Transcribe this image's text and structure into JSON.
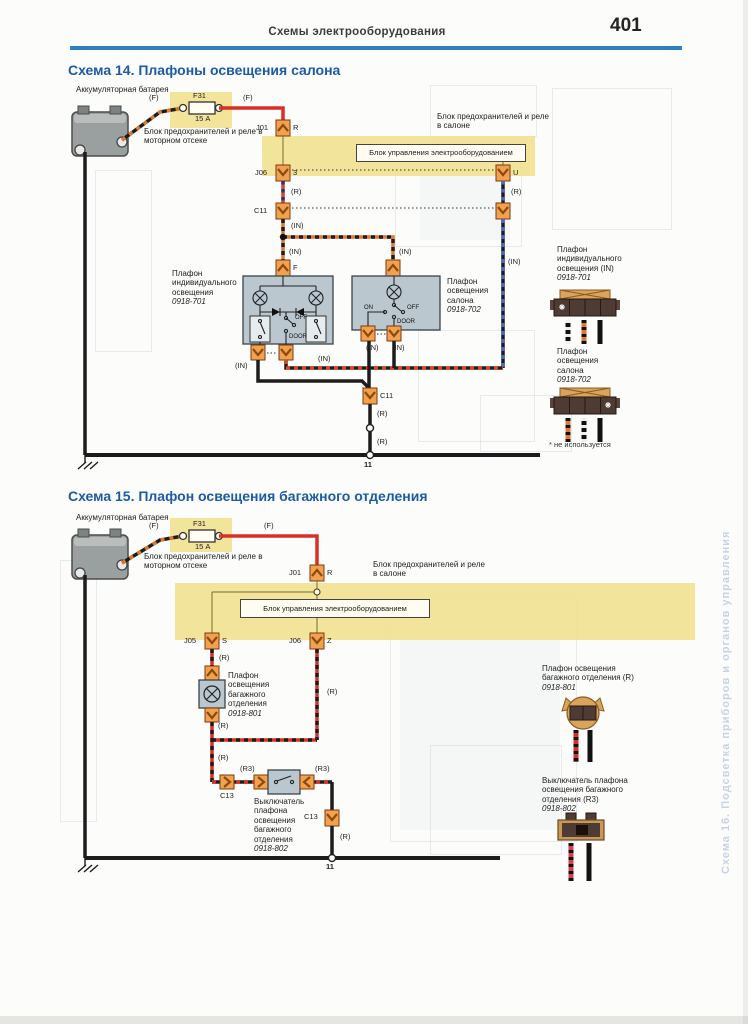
{
  "page": {
    "header": "Схемы электрооборудования",
    "number": "401"
  },
  "common": {
    "battery": "Аккумуляторная батарея",
    "wire_f": "(F)",
    "fuse": "F31",
    "fuse_rating": "15 А",
    "engine_block": "Блок предохранителей и реле в моторном отсеке",
    "cabin_block": "Блок предохранителей и реле в салоне",
    "ecu": "Блок управления электрооборудованием",
    "j01": "J01",
    "pin_r": "R",
    "wire_r": "(R)",
    "wire_in": "(IN)",
    "ground_node": "11"
  },
  "s14": {
    "title": "Схема 14. Плафоны освещения салона",
    "j06": "J06",
    "pin_3": "3",
    "pin_u": "U",
    "c11": "C11",
    "pin_f": "F",
    "sw_on": "ON",
    "sw_off": "OFF",
    "sw_door": "DOOR",
    "lamp1": {
      "name": "Плафон индивидуального освещения",
      "code": "0918-701"
    },
    "lamp2": {
      "name": "Плафон освещения салона",
      "code": "0918-702"
    },
    "legend": [
      {
        "name": "Плафон индивидуального освещения (IN)",
        "code": "0918-701"
      },
      {
        "name": "Плафон освещения салона",
        "code": "0918-702"
      }
    ],
    "footnote": "* не используется"
  },
  "s15": {
    "title": "Схема 15. Плафон освещения багажного отделения",
    "j05": "J05",
    "pin_s": "S",
    "j06": "J06",
    "pin_z": "Z",
    "c13": "C13",
    "wire_r3": "(R3)",
    "lamp": {
      "name": "Плафон освещения багажного отделения",
      "code": "0918-801"
    },
    "switch": {
      "name": "Выключатель плафона освещения багажного отделения",
      "code": "0918-802"
    },
    "legend": [
      {
        "name": "Плафон освещения багажного отделения (R)",
        "code": "0918-801"
      },
      {
        "name": "Выключатель плафона освещения багажного отделения (R3)",
        "code": "0918-802"
      }
    ]
  },
  "bleed": {
    "vertical_text": "Схема 16. Подсветка приборов и органов управления"
  },
  "colors": {
    "accent_blue": "#1b5aa8",
    "rule_blue": "#2e7ec0",
    "highlight_yellow": "#f2e190",
    "wire_red": "#d83028",
    "wire_orange": "#e07830",
    "connector_orange": "#f2a24e"
  }
}
